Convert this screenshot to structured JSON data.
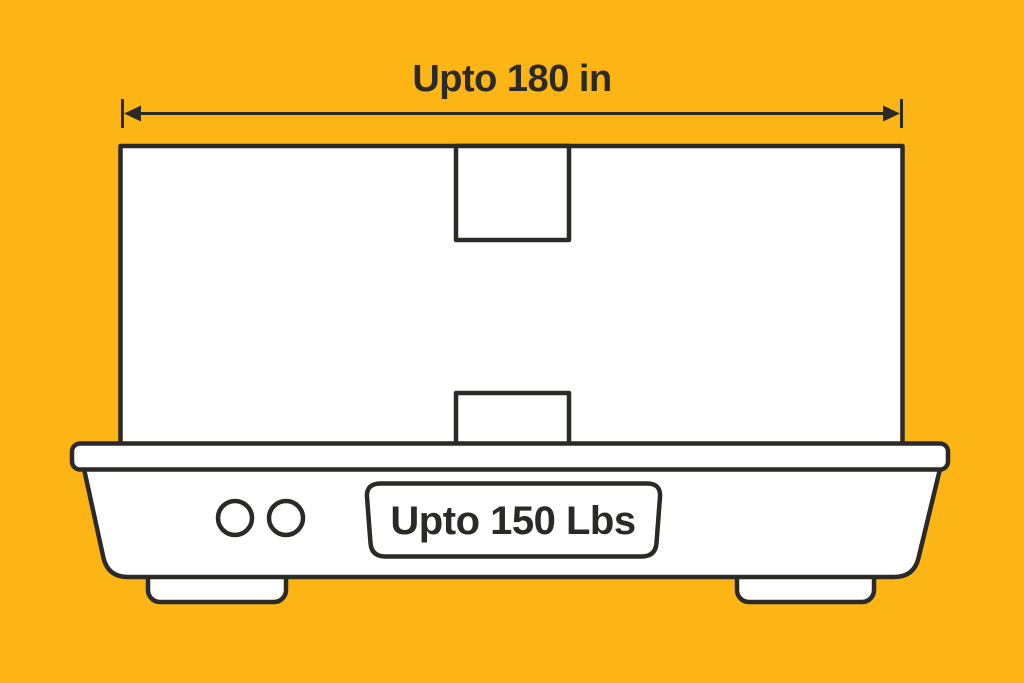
{
  "illustration": {
    "dimension_label": "Upto 180 in",
    "weight_label": "Upto 150 Lbs"
  },
  "colors": {
    "background": "#FDB515",
    "stroke": "#2B2A26",
    "white": "#FFFFFF"
  }
}
